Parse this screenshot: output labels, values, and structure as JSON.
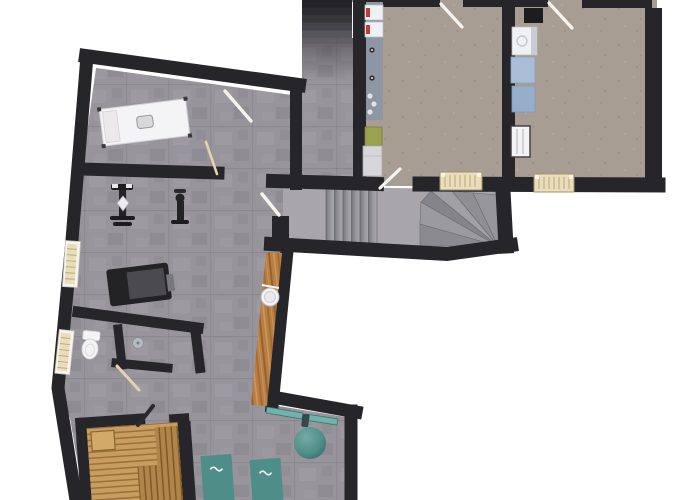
{
  "meta": {
    "description": "Top-down 3D architectural render of a basement wellness / fitness floor plan, no text labels visible",
    "view": "floor-plan-3d-top-down",
    "background": "#ffffff"
  },
  "colors": {
    "background": "#ffffff",
    "wall": "#26262a",
    "wallDark": "#1d1d20",
    "floorStone": "#98949c",
    "floorRoom": "#a89d92",
    "floorStair": "#a8a6aa",
    "stairTopDark": "#35353a",
    "treadDark": "#8a8a90",
    "treadMid": "#8e8e94",
    "treadLight": "#9a9aa0",
    "woodBar": "#b97e41",
    "saunaWood": "#c99c5f",
    "saunaWoodLight": "#d2a968",
    "saunaWoodDark": "#b0854a",
    "teal": "#4f8e88",
    "tealLight": "#6fb3ac",
    "tealDark": "#2f6561",
    "furnitureWhite": "#f3f2f4",
    "equipmentBlack": "#232326",
    "deckGray": "#4a4a4f",
    "radiatorBeige": "#e9ddbb",
    "radiatorLine": "#b9a678",
    "applianceWhite": "#f0f1f4",
    "applianceBlue": "#a9bed6",
    "applianceBlue2": "#97aecb",
    "cabinetGray": "#d7d7d9",
    "binGreen": "#9aa24f",
    "counterBlue": "#8d96a3",
    "doorWhite": "#f6f4ef",
    "doorWood": "#e3d3ac",
    "doorDark": "#2a2a2e",
    "drainGray": "#b7bcc4",
    "toiletWhite": "#f4f3f5",
    "railWhite": "#f5f5f5",
    "accentRed": "#c23b36"
  },
  "rooms": [
    {
      "name": "fitness-area",
      "floor": "stone-gray",
      "items": [
        "massage-table",
        "exercise-machine-left",
        "exercise-machine-right",
        "weight-bench"
      ]
    },
    {
      "name": "shower-wc",
      "floor": "stone-gray",
      "items": [
        "toilet",
        "shower-drain"
      ]
    },
    {
      "name": "sauna",
      "floor": "wood",
      "items": [
        "sauna-stool",
        "sauna-bench-right",
        "sauna-bench-lower"
      ]
    },
    {
      "name": "relax-area",
      "floor": "stone-gray",
      "items": [
        "bar-counter",
        "round-basin",
        "wall-shelf",
        "hanging-bag",
        "exercise-ball",
        "lounger-left",
        "lounger-right"
      ]
    },
    {
      "name": "stair-hall",
      "floor": "stone-gray",
      "items": [
        "straight-stair-flight",
        "winder-stairs"
      ]
    },
    {
      "name": "upper-corridor",
      "floor": "stone-gray",
      "items": [
        "upper-stair-flight",
        "handrail"
      ]
    },
    {
      "name": "utility-room",
      "floor": "screed-beige",
      "items": [
        "appliance-counter",
        "boiler-unit-1",
        "boiler-unit-2",
        "green-bin",
        "low-cabinet",
        "radiator"
      ]
    },
    {
      "name": "laundry-room",
      "floor": "screed-beige",
      "items": [
        "flue-box",
        "washer",
        "dryer-1",
        "dryer-2",
        "white-radiator",
        "radiator"
      ]
    }
  ],
  "windows": [
    "window-upper-left",
    "window-lower-left"
  ],
  "doors": [
    "fitness-entry-door",
    "massage-partition-door",
    "stair-hall-door",
    "wc-door",
    "sauna-door",
    "utility-room-top-door",
    "utility-room-hall-door",
    "laundry-room-door"
  ]
}
